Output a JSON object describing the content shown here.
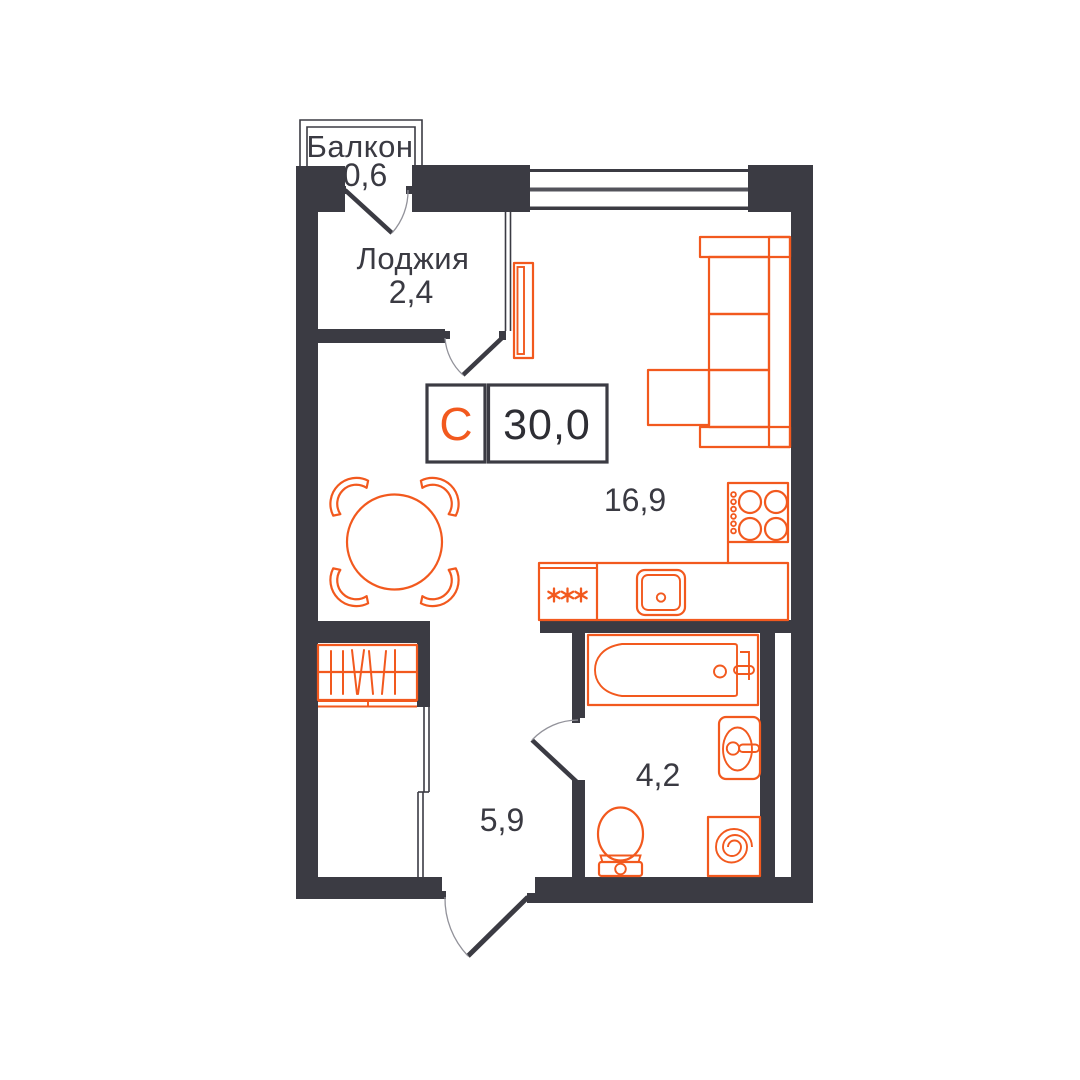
{
  "badge": {
    "type_letter": "С",
    "total_area": "30,0"
  },
  "labels": {
    "balcony_name": "Балкон",
    "balcony_area": "0,6",
    "loggia_name": "Лоджия",
    "loggia_area": "2,4",
    "living_area": "16,9",
    "bathroom_area": "4,2",
    "hall_area": "5,9"
  },
  "colors": {
    "walls": "#3B3B43",
    "furniture_accent": "#F2591E",
    "label_text": "#3A3A42",
    "background": "#FFFFFF"
  }
}
